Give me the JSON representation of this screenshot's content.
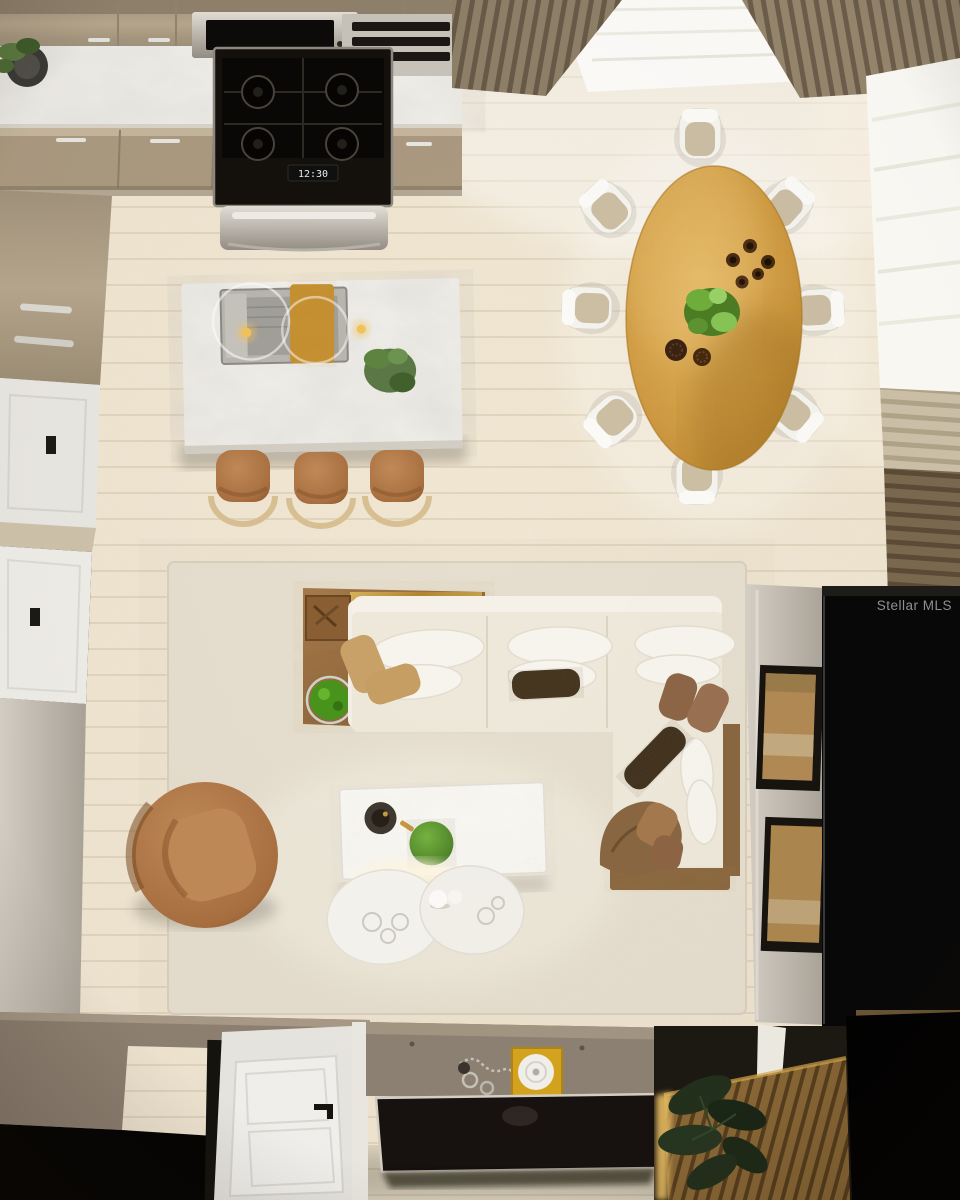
{
  "watermark": {
    "label": "Stellar MLS"
  },
  "kitchen": {
    "stove_display": "12:30"
  },
  "scene": {
    "type": "top-down interior rendering",
    "rooms": [
      "kitchen",
      "dining area",
      "living room",
      "entry"
    ]
  },
  "palette": {
    "floor_wood": "#f1e7d3",
    "area_rug": "#e8e1d1",
    "marble_counter": "#f4f2ed",
    "cabinet_taupe": "#b3a288",
    "dining_table_wood": "#d29c42",
    "sofa_upholstery": "#efe9db",
    "camel_leather": "#b0774a",
    "brass_accent": "#c9a44c",
    "media_panel_black": "#080808",
    "slat_wood_brown": "#8a6836",
    "accent_yellow_tray": "#d6a51e",
    "plant_green": "#4f9427",
    "watermark_gray": "#9a9a9a"
  }
}
